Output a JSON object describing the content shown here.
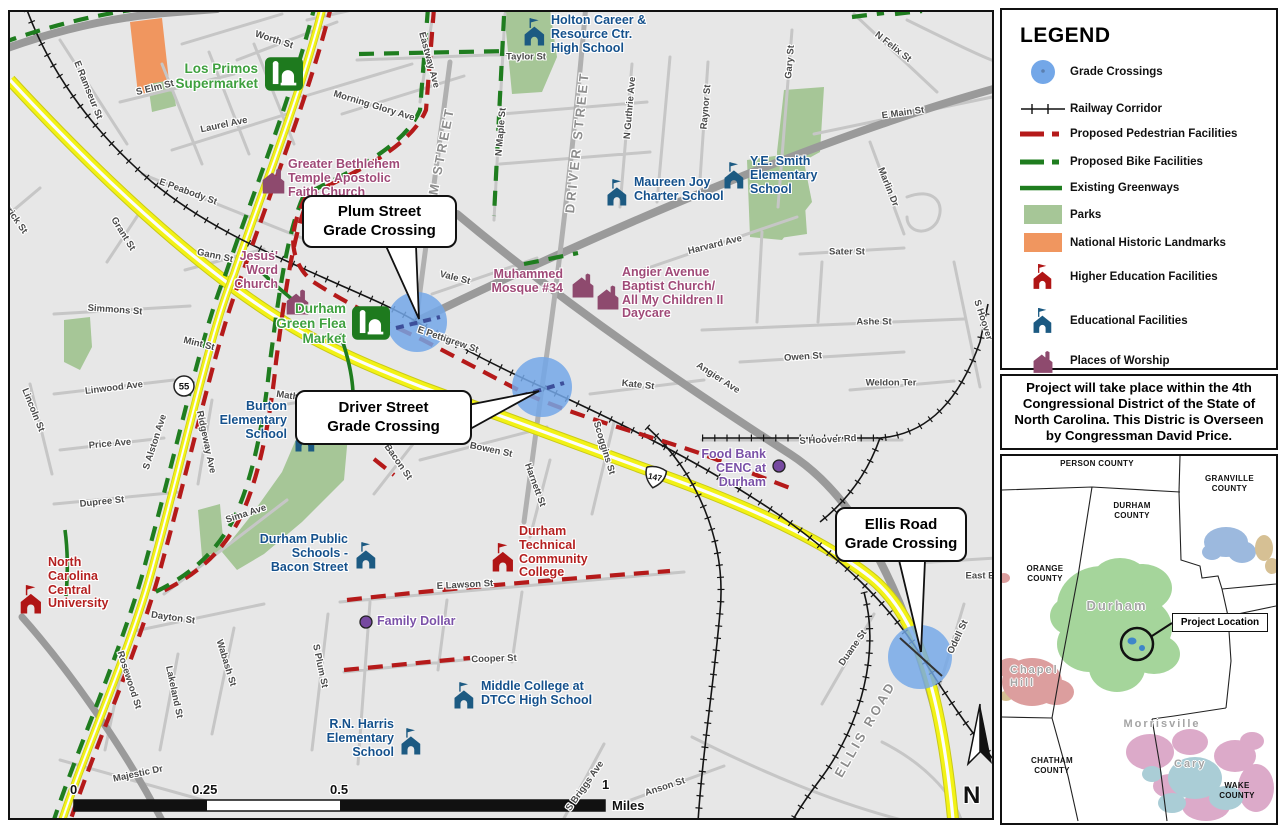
{
  "legend": {
    "title": "LEGEND",
    "items": [
      {
        "key": "grade-crossings",
        "label": "Grade Crossings"
      },
      {
        "key": "railway-corridor",
        "label": "Railway Corridor"
      },
      {
        "key": "proposed-pedestrian",
        "label": "Proposed Pedestrian Facilities"
      },
      {
        "key": "proposed-bike",
        "label": "Proposed Bike Facilities"
      },
      {
        "key": "existing-greenways",
        "label": "Existing Greenways"
      },
      {
        "key": "parks",
        "label": "Parks"
      },
      {
        "key": "national-historic-landmarks",
        "label": "National Historic Landmarks"
      },
      {
        "key": "higher-education",
        "label": "Higher Education Facilities"
      },
      {
        "key": "educational",
        "label": "Educational Facilities"
      },
      {
        "key": "places-of-worship",
        "label": "Places of Worship"
      }
    ]
  },
  "district_note": "Project will take place within the 4th Congressional District of the State of North Carolina. This Distric is Overseen by Congressman David Price.",
  "callouts": [
    {
      "label": "Plum Street\nGrade Crossing"
    },
    {
      "label": "Driver Street\nGrade Crossing"
    },
    {
      "label": "Ellis Road\nGrade Crossing"
    }
  ],
  "shields": {
    "nc55": "55",
    "nc147": "147"
  },
  "north": {
    "label": "N"
  },
  "scale_bar": {
    "t0": "0",
    "t025": "0.25",
    "t05": "0.5",
    "t1": "1",
    "unit": "Miles"
  },
  "inset": {
    "person": "PERSON COUNTY",
    "granville": "GRANVILLE\nCOUNTY",
    "durham_county": "DURHAM\nCOUNTY",
    "orange": "ORANGE\nCOUNTY",
    "chatham": "CHATHAM\nCOUNTY",
    "wake": "WAKE\nCOUNTY",
    "city_durham": "Durham",
    "city_chapel_hill": "Chapel\nHill",
    "city_morrisville": "Morrisville",
    "city_cary": "Cary",
    "project_location": "Project Location"
  },
  "colors": {
    "grade_crossing": "#73a7e8",
    "pedestrian": "#b51a1a",
    "bike": "#1f7d1f",
    "greenway": "#1f7d1f",
    "park": "#a6c697",
    "landmark": "#f0965f",
    "higher_ed": "#b01515",
    "educational": "#1c5a82",
    "worship": "#8e4a6e",
    "highway_yellow": "#f2f216",
    "purple_poi": "#7649a0"
  },
  "map": {
    "street_labels": [
      {
        "t": "Worth St",
        "x": 272,
        "y": 38,
        "r": 18
      },
      {
        "t": "E Ramseur St",
        "x": 86,
        "y": 88,
        "r": 68
      },
      {
        "t": "S Elm St",
        "x": 153,
        "y": 86,
        "r": -14
      },
      {
        "t": "Laurel Ave",
        "x": 222,
        "y": 123,
        "r": -12
      },
      {
        "t": "E Peabody St",
        "x": 186,
        "y": 190,
        "r": 20
      },
      {
        "t": "Morning Glory Ave",
        "x": 372,
        "y": 104,
        "r": 17
      },
      {
        "t": "Eastway Ave",
        "x": 427,
        "y": 58,
        "r": 75
      },
      {
        "t": "Taylor St",
        "x": 524,
        "y": 55,
        "r": 0
      },
      {
        "t": "N Maple St",
        "x": 499,
        "y": 130,
        "r": -85
      },
      {
        "t": "N Guthrie Ave",
        "x": 628,
        "y": 106,
        "r": -85
      },
      {
        "t": "Gary St",
        "x": 788,
        "y": 60,
        "r": -85
      },
      {
        "t": "Raynor St",
        "x": 704,
        "y": 105,
        "r": -85
      },
      {
        "t": "N Felix St",
        "x": 891,
        "y": 45,
        "r": 38
      },
      {
        "t": "E Main St",
        "x": 901,
        "y": 111,
        "r": -8
      },
      {
        "t": "Marlin Dr",
        "x": 886,
        "y": 185,
        "r": 68
      },
      {
        "t": "Harvard Ave",
        "x": 713,
        "y": 243,
        "r": -14
      },
      {
        "t": "Sater St",
        "x": 845,
        "y": 250,
        "r": 0
      },
      {
        "t": "Ashe St",
        "x": 872,
        "y": 320,
        "r": 0
      },
      {
        "t": "Owen St",
        "x": 801,
        "y": 355,
        "r": -4
      },
      {
        "t": "Weldon Ter",
        "x": 889,
        "y": 381,
        "r": 0
      },
      {
        "t": "Kate St",
        "x": 636,
        "y": 383,
        "r": 6
      },
      {
        "t": "Angier Ave",
        "x": 716,
        "y": 376,
        "r": 33
      },
      {
        "t": "S Hoover Rd",
        "x": 826,
        "y": 438,
        "r": -3
      },
      {
        "t": "S Hoover",
        "x": 981,
        "y": 318,
        "r": 72
      },
      {
        "t": "Vale St",
        "x": 453,
        "y": 276,
        "r": 14
      },
      {
        "t": "Gann St",
        "x": 213,
        "y": 254,
        "r": 12
      },
      {
        "t": "Mint St",
        "x": 197,
        "y": 342,
        "r": 14
      },
      {
        "t": "E Pettigrew St",
        "x": 446,
        "y": 338,
        "r": 19
      },
      {
        "t": "Simmons St",
        "x": 113,
        "y": 308,
        "r": 4
      },
      {
        "t": "Grant St",
        "x": 121,
        "y": 232,
        "r": 58
      },
      {
        "t": "Merrick St",
        "x": 10,
        "y": 212,
        "r": 55
      },
      {
        "t": "Lincoln St",
        "x": 31,
        "y": 408,
        "r": 68
      },
      {
        "t": "Linwood Ave",
        "x": 112,
        "y": 386,
        "r": -7
      },
      {
        "t": "Price Ave",
        "x": 108,
        "y": 442,
        "r": -5
      },
      {
        "t": "Dupree St",
        "x": 100,
        "y": 500,
        "r": -6
      },
      {
        "t": "S Alston Ave",
        "x": 153,
        "y": 440,
        "r": -72
      },
      {
        "t": "Ridgeway Ave",
        "x": 204,
        "y": 440,
        "r": 78
      },
      {
        "t": "Mathison St",
        "x": 301,
        "y": 396,
        "r": 8
      },
      {
        "t": "Sima Ave",
        "x": 244,
        "y": 512,
        "r": -18
      },
      {
        "t": "Dayton St",
        "x": 171,
        "y": 616,
        "r": 8
      },
      {
        "t": "Rosewood St",
        "x": 127,
        "y": 678,
        "r": 72
      },
      {
        "t": "Lakeland St",
        "x": 172,
        "y": 690,
        "r": 78
      },
      {
        "t": "Wabash St",
        "x": 224,
        "y": 661,
        "r": 73
      },
      {
        "t": "S Plum St",
        "x": 318,
        "y": 664,
        "r": 78
      },
      {
        "t": "Majestic Dr",
        "x": 136,
        "y": 772,
        "r": -12
      },
      {
        "t": "Bacon St",
        "x": 396,
        "y": 460,
        "r": 55
      },
      {
        "t": "Bowen St",
        "x": 489,
        "y": 448,
        "r": 12
      },
      {
        "t": "Harnett St",
        "x": 533,
        "y": 483,
        "r": 70
      },
      {
        "t": "Scoggins St",
        "x": 602,
        "y": 446,
        "r": 73
      },
      {
        "t": "E Lawson St",
        "x": 463,
        "y": 583,
        "r": -3
      },
      {
        "t": "Cooper St",
        "x": 492,
        "y": 657,
        "r": -2
      },
      {
        "t": "S Briggs Ave",
        "x": 583,
        "y": 784,
        "r": -55
      },
      {
        "t": "Anson St",
        "x": 663,
        "y": 785,
        "r": -18
      },
      {
        "t": "Duane St",
        "x": 851,
        "y": 646,
        "r": -55
      },
      {
        "t": "Odell St",
        "x": 956,
        "y": 635,
        "r": -65
      },
      {
        "t": "East E",
        "x": 978,
        "y": 574,
        "r": 0
      },
      {
        "t": "PLUM STREET",
        "x": 436,
        "y": 166,
        "r": -79,
        "big": true
      },
      {
        "t": "DRIVER STREET",
        "x": 575,
        "y": 140,
        "r": -84,
        "big": true
      },
      {
        "t": "ELLIS ROAD",
        "x": 863,
        "y": 727,
        "r": -60,
        "big": true
      }
    ],
    "facilities": [
      {
        "t": "Los Primos\nSupermarket",
        "lx": 256,
        "ly": 60,
        "align": "right",
        "cls": "green",
        "icon": "store",
        "ix": 263,
        "iy": 55,
        "is": 38,
        "fs": 13.5
      },
      {
        "t": "Holton Career &\nResource Ctr.\nHigh School",
        "lx": 549,
        "ly": 12,
        "align": "left",
        "cls": "navy",
        "icon": "school",
        "ix": 520,
        "iy": 16,
        "is": 26
      },
      {
        "t": "Greater Bethlehem\nTemple Apostolic\nFaith Church",
        "lx": 286,
        "ly": 156,
        "align": "left",
        "cls": "maroon",
        "icon": "worship",
        "ix": 258,
        "iy": 163,
        "is": 27
      },
      {
        "t": "Maureen Joy\nCharter School",
        "lx": 632,
        "ly": 174,
        "align": "left",
        "cls": "navy",
        "icon": "school",
        "ix": 603,
        "iy": 177,
        "is": 25
      },
      {
        "t": "Y.E. Smith\nElementary\nSchool",
        "lx": 748,
        "ly": 153,
        "align": "left",
        "cls": "navy",
        "icon": "school",
        "ix": 720,
        "iy": 160,
        "is": 25
      },
      {
        "t": "Jesus'\nWord\nChurch",
        "lx": 276,
        "ly": 248,
        "align": "right",
        "cls": "maroon",
        "icon": "worship",
        "ix": 282,
        "iy": 284,
        "is": 27
      },
      {
        "t": "Durham\nGreen Flea\nMarket",
        "lx": 344,
        "ly": 300,
        "align": "right",
        "cls": "green",
        "icon": "store",
        "ix": 350,
        "iy": 304,
        "is": 38,
        "fs": 13.5
      },
      {
        "t": "Muhammed\nMosque #34",
        "lx": 561,
        "ly": 266,
        "align": "right",
        "cls": "maroon",
        "icon": "worship",
        "ix": 568,
        "iy": 268,
        "is": 26
      },
      {
        "t": "Angier Avenue\nBaptist Church/\nAll My Children II\nDaycare",
        "lx": 620,
        "ly": 264,
        "align": "left",
        "cls": "maroon",
        "icon": "worship",
        "ix": 593,
        "iy": 280,
        "is": 26
      },
      {
        "t": "Burton\nElementary\nSchool",
        "lx": 285,
        "ly": 398,
        "align": "right",
        "cls": "navy",
        "icon": "school",
        "ix": 291,
        "iy": 423,
        "is": 25
      },
      {
        "t": "Durham Public\nSchools -\nBacon Street",
        "lx": 346,
        "ly": 531,
        "align": "right",
        "cls": "navy",
        "icon": "school",
        "ix": 352,
        "iy": 540,
        "is": 25
      },
      {
        "t": "North\nCarolina\nCentral\nUniversity",
        "lx": 46,
        "ly": 554,
        "align": "left",
        "cls": "red4",
        "icon": "hied",
        "ix": 16,
        "iy": 583,
        "is": 27
      },
      {
        "t": "Durham\nTechnical\nCommunity\nCollege",
        "lx": 517,
        "ly": 523,
        "align": "left",
        "cls": "red4",
        "icon": "hied",
        "ix": 488,
        "iy": 541,
        "is": 27
      },
      {
        "t": "Family Dollar",
        "lx": 375,
        "ly": 613,
        "align": "left",
        "cls": "purple",
        "icon": "dot",
        "ix": 357,
        "iy": 613,
        "is": 14
      },
      {
        "t": "Middle College at\nDTCC High School",
        "lx": 479,
        "ly": 678,
        "align": "left",
        "cls": "navy",
        "icon": "school",
        "ix": 450,
        "iy": 680,
        "is": 25
      },
      {
        "t": "R.N. Harris\nElementary\nSchool",
        "lx": 392,
        "ly": 716,
        "align": "right",
        "cls": "navy",
        "icon": "school",
        "ix": 397,
        "iy": 726,
        "is": 25
      },
      {
        "t": "Food Bank\nCENC at\nDurham",
        "lx": 764,
        "ly": 446,
        "align": "right",
        "cls": "purple",
        "icon": "dot",
        "ix": 770,
        "iy": 457,
        "is": 14
      }
    ]
  }
}
